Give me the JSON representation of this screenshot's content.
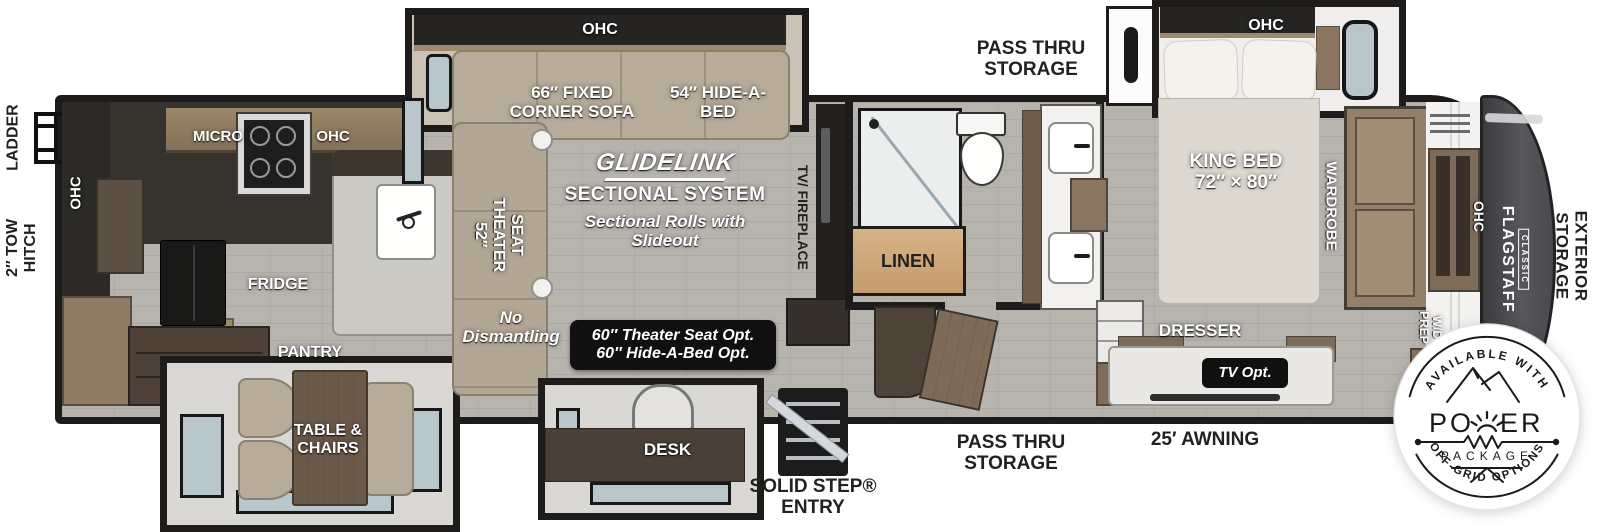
{
  "floorplan": {
    "exterior": {
      "ladder": "LADDER",
      "tow_hitch_line1": "2″ TOW",
      "tow_hitch_line2": "HITCH",
      "exterior_storage_line1": "EXTERIOR",
      "exterior_storage_line2": "STORAGE",
      "pass_thru_top_line1": "PASS THRU",
      "pass_thru_top_line2": "STORAGE",
      "pass_thru_bottom_line1": "PASS THRU",
      "pass_thru_bottom_line2": "STORAGE",
      "awning": "25′ AWNING",
      "entry_line1": "SOLID STEP®",
      "entry_line2": "ENTRY"
    },
    "kitchen": {
      "ohc_side": "OHC",
      "micro": "MICRO",
      "ohc_top": "OHC",
      "fridge": "FRIDGE",
      "pantry": "PANTRY"
    },
    "dinette": {
      "label_line1": "TABLE &",
      "label_line2": "CHAIRS"
    },
    "living": {
      "ohc": "OHC",
      "sofa_line1": "66″ FIXED",
      "sofa_line2": "CORNER SOFA",
      "hide_a_bed_line1": "54″ HIDE-A-",
      "hide_a_bed_line2": "BED",
      "theater_line1": "SEAT",
      "theater_line2": "THEATER",
      "theater_line3": "52″",
      "glidelink": "GLIDELINK",
      "sectional_system": "SECTIONAL SYSTEM",
      "rolls_line1": "Sectional Rolls with",
      "rolls_line2": "Slideout",
      "no_dismantling_line1": "No",
      "no_dismantling_line2": "Dismantling",
      "opt_line1": "60″ Theater Seat Opt.",
      "opt_line2": "60″ Hide-A-Bed Opt.",
      "tv_fireplace": "TV/ FIREPLACE",
      "desk": "DESK"
    },
    "bathroom": {
      "linen": "LINEN"
    },
    "bedroom": {
      "ohc": "OHC",
      "king_line1": "KING BED",
      "king_line2": "72″ × 80″",
      "wardrobe": "WARDROBE",
      "dresser": "DRESSER",
      "tv_opt": "TV Opt.",
      "wd_line1": "W/D",
      "wd_line2": "PREP",
      "ohc_front": "OHC"
    },
    "brand": {
      "name": "FLAGSTAFF",
      "series": "CLASSIC"
    },
    "badge": {
      "top_text": "AVAILABLE WITH",
      "power_word": "POWER",
      "power_part1": "PO",
      "power_part2": "ER",
      "package": "PACKAGE",
      "bottom_text": "OFF-GRID OPTIONS"
    },
    "colors": {
      "wall": "#1d1c1a",
      "floor": "#b7b4ae",
      "wood": "#8a7660",
      "dark_zone": "#34312d",
      "badge_ink": "#1a1a1a"
    }
  }
}
